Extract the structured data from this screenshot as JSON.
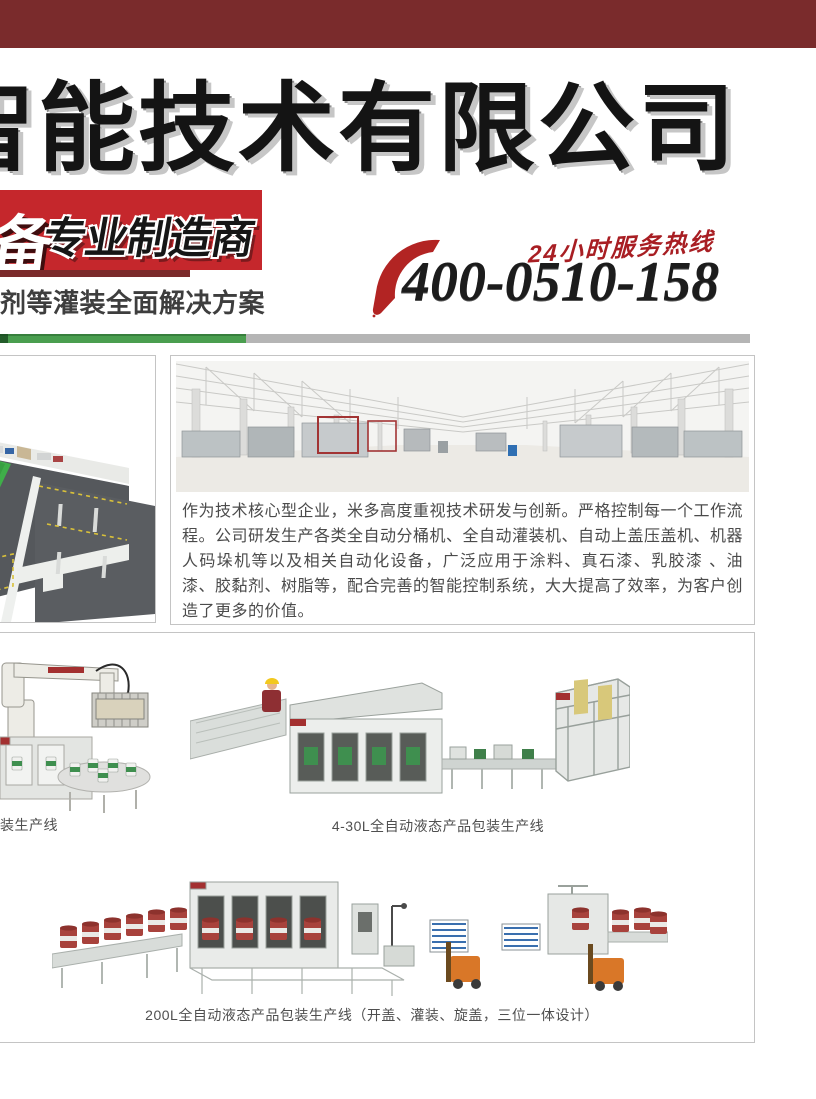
{
  "header": {
    "bar_color": "#7a2b2c",
    "title": "智能技术有限公司",
    "title_color": "#141414"
  },
  "badge": {
    "bg_color": "#c5272c",
    "strip_color": "#7b2a2b",
    "prefix": "备",
    "label": "专业制造商"
  },
  "tagline": "剂等灌装全面解决方案",
  "hotline": {
    "icon": "phone-swoosh-icon",
    "icon_color": "#b22423",
    "label": "24小时服务热线",
    "label_color": "#a81e23",
    "number": "400-0510-158"
  },
  "divider": {
    "green": "#4a9e4f",
    "green_dark": "#235c2a",
    "gray": "#b5b5b5"
  },
  "about": {
    "paragraph": "作为技术核心型企业，米多高度重视技术研发与创新。严格控制每一个工作流程。公司研发生产各类全自动分桶机、全自动灌装机、自动上盖压盖机、机器人码垛机等以及相关自动化设备，广泛应用于涂料、真石漆、乳胶漆 、油漆、胶黏剂、树脂等，配合完善的智能控制系统，大大提高了效率，为客户创造了更多的价值。"
  },
  "products": {
    "caption_left": "装生产线",
    "caption_mid": "4-30L全自动液态产品包装生产线",
    "caption_bottom": "200L全自动液态产品包装生产线（开盖、灌装、旋盖，三位一体设计）"
  },
  "images": [
    "factory-layout-3d-image",
    "factory-interior-photo",
    "robot-palletizer-image",
    "filling-line-4-30l-image",
    "drum-line-200l-image"
  ]
}
